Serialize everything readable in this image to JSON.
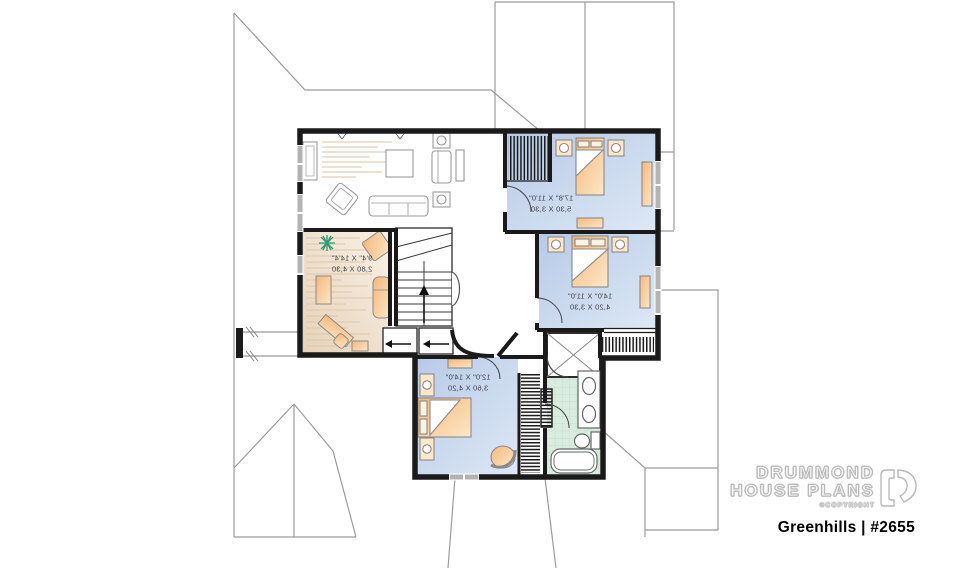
{
  "colors": {
    "wall": "#1a1a1a",
    "roof_line": "#9b9b9b",
    "bedroom_floor": "#c3d4eb",
    "den_floor": "#eddcc7",
    "bath_floor": "#d9ecdf",
    "furniture": "#f4b87c",
    "furniture_light": "#fde7c6",
    "fixture_outline": "#8a8a8a",
    "window": "#b3b3b3",
    "plant": "#2f9d74",
    "label_text": "#3f3f46",
    "brand_outline": "#b9b9b9",
    "title_text": "#000000"
  },
  "plan": {
    "text_mirrored": true,
    "rooms": [
      {
        "id": "bedroom-1",
        "imperial": "17'8\" X 11'0\"",
        "metric": "5,30 X 3,30"
      },
      {
        "id": "bedroom-2",
        "imperial": "14'0\" X 11'0\"",
        "metric": "4,20 X 3,30"
      },
      {
        "id": "bedroom-3",
        "imperial": "12'0\" X 14'0\"",
        "metric": "3,60 X 4,20"
      },
      {
        "id": "sitting-area",
        "imperial": "9'4\" X 14'4\"",
        "metric": "2,80 X 4,30"
      }
    ]
  },
  "branding": {
    "name_line1": "DRUMMOND",
    "name_line2": "HOUSE PLANS",
    "copyright": "©COPYRIGHT",
    "logo_icon": "drummond-d-icon",
    "plan_title": "Greenhills | #2655"
  }
}
